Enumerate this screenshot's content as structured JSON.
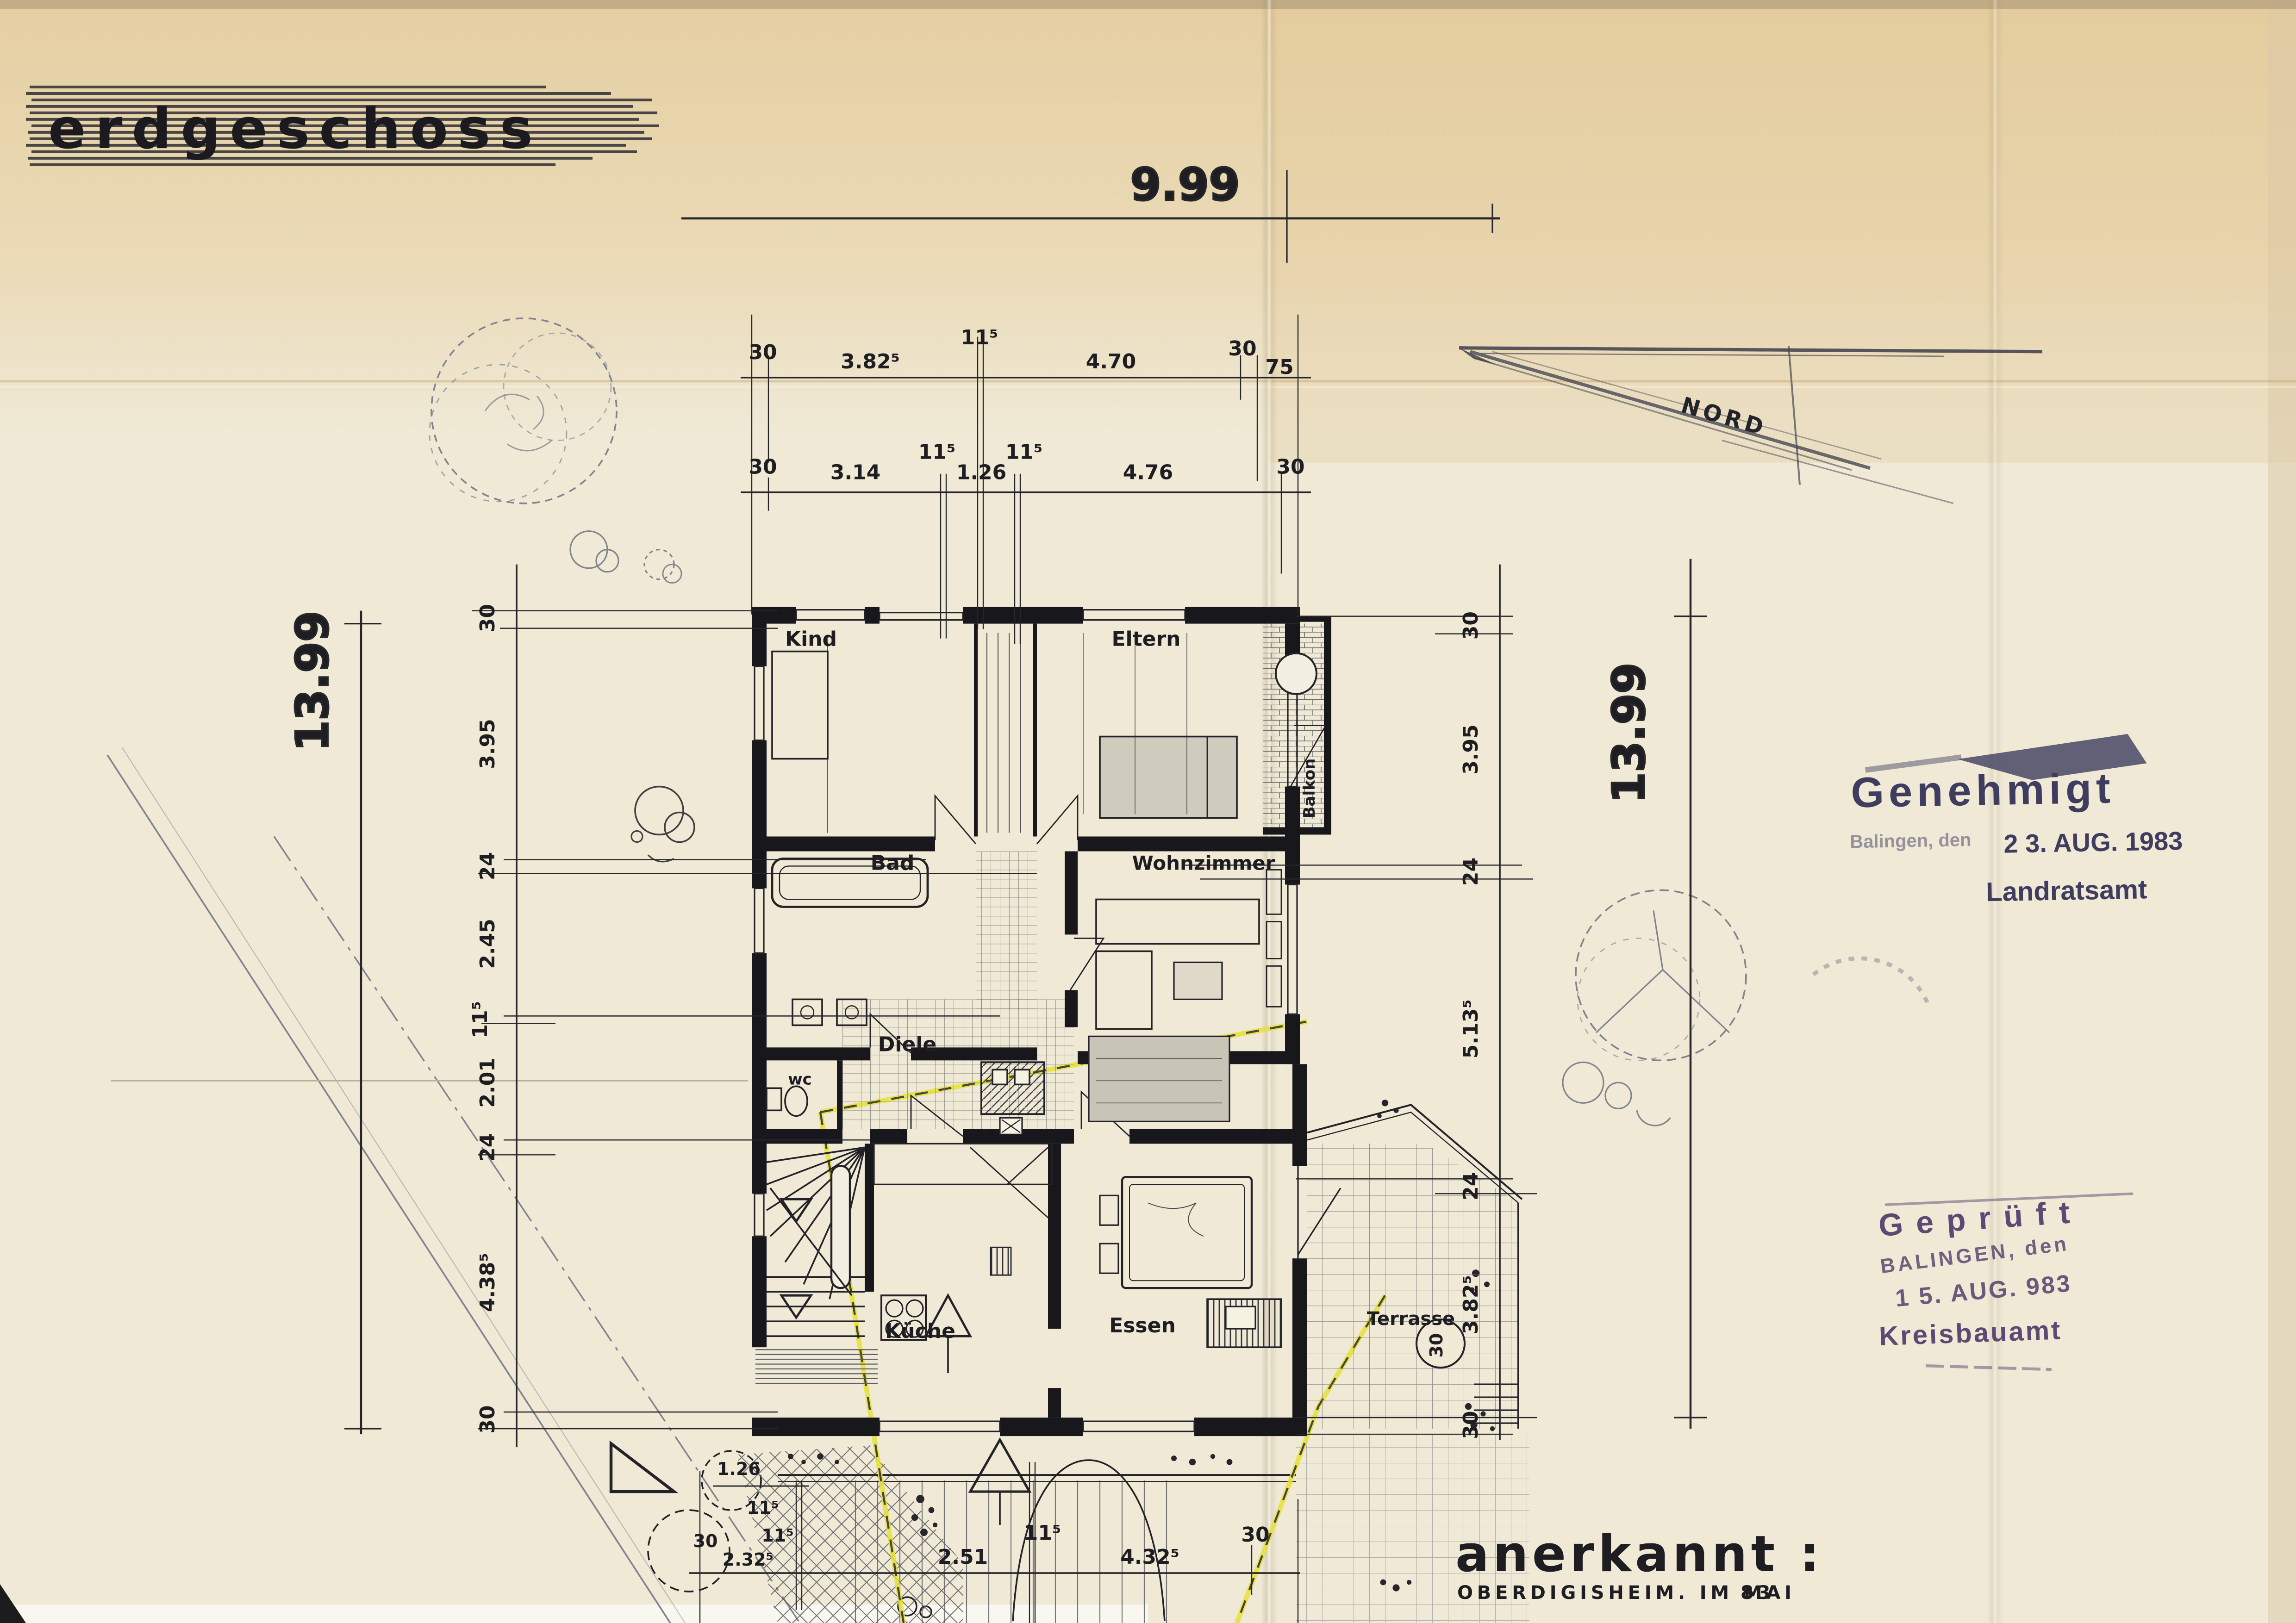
{
  "title": "erdgeschoss",
  "north_label": "NORD",
  "rooms": {
    "kind": "Kind",
    "eltern": "Eltern",
    "balkon": "Balkon",
    "bad": "Bad",
    "wohnzimmer": "Wohnzimmer",
    "diele": "Diele",
    "wc": "wc",
    "kueche": "Küche",
    "essen": "Essen",
    "terrasse": "Terrasse"
  },
  "dims": {
    "width_total": "9.99",
    "height_total": "13.99",
    "top_row1": [
      "30",
      "3.82⁵",
      "11⁵",
      "4.70",
      "30",
      "75"
    ],
    "top_row2": [
      "30",
      "3.14",
      "11⁵",
      "1.26",
      "11⁵",
      "4.76",
      "30"
    ],
    "left_chain": [
      "30",
      "3.95",
      "24",
      "2.45",
      "11⁵",
      "2.01",
      "24",
      "4.38⁵",
      "30"
    ],
    "right_chain": [
      "30",
      "3.95",
      "24",
      "5.13⁵",
      "24",
      "3.82⁵",
      "30"
    ],
    "bottom_chain": [
      "30",
      "2.32⁵",
      "11⁵",
      "2.51",
      "11⁵",
      "4.32⁵",
      "30"
    ],
    "entry_width": "1.26",
    "entry_wall": "11⁵",
    "terrace_offset": "30"
  },
  "stamps": {
    "approved": {
      "line1": "Genehmigt",
      "line2": "Balingen, den",
      "date": "2 3. AUG. 1983",
      "line3": "Landratsamt",
      "color": "#3e3d5f"
    },
    "checked": {
      "line1": "Geprüft",
      "line2": "BALINGEN, den",
      "date": "1 5. AUG. 983",
      "line3": "Kreisbauamt",
      "color": "#5d4973"
    }
  },
  "approval": {
    "line1": "anerkannt :",
    "line2": "OBERDIGISHEIM. IM MAI",
    "year": "83"
  },
  "colors": {
    "paper": "#efe9d6",
    "paper_tan": "#e5cd9c",
    "ink": "#1d1d22",
    "stamp_blue": "#3e3d5f",
    "stamp_purple": "#5d4973",
    "boundary_yellow": "#e8e037"
  }
}
